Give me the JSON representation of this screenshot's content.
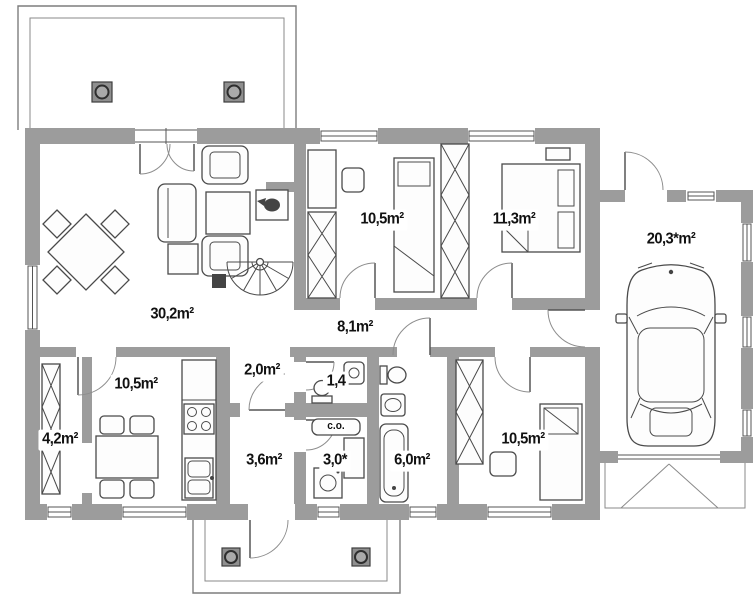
{
  "plan_title": "Single-storey house floor plan with garage",
  "rooms": [
    {
      "id": "living-room",
      "area": "30,2m²"
    },
    {
      "id": "kitchen",
      "area": "10,5m²"
    },
    {
      "id": "closet",
      "area": "4,2m²"
    },
    {
      "id": "vestibule",
      "area": "2,0m²"
    },
    {
      "id": "wc",
      "area": "1,4"
    },
    {
      "id": "back-corridor",
      "area": "3,6m²"
    },
    {
      "id": "boiler-room",
      "area": "3,0*"
    },
    {
      "id": "bathroom",
      "area": "6,0m²"
    },
    {
      "id": "hall",
      "area": "8,1m²"
    },
    {
      "id": "bedroom-top-middle",
      "area": "10,5m²"
    },
    {
      "id": "bedroom-top-right",
      "area": "11,3m²"
    },
    {
      "id": "bedroom-bottom",
      "area": "10,5m²"
    },
    {
      "id": "garage",
      "area": "20,3*m²"
    }
  ],
  "equipment_labels": {
    "central_heating_boiler": "c.o."
  },
  "colors": {
    "wall": "#9c9c9c",
    "floor": "#ffffff",
    "line": "#4a4a4a",
    "label_text": "#111111",
    "label_background": "#ffffff"
  }
}
